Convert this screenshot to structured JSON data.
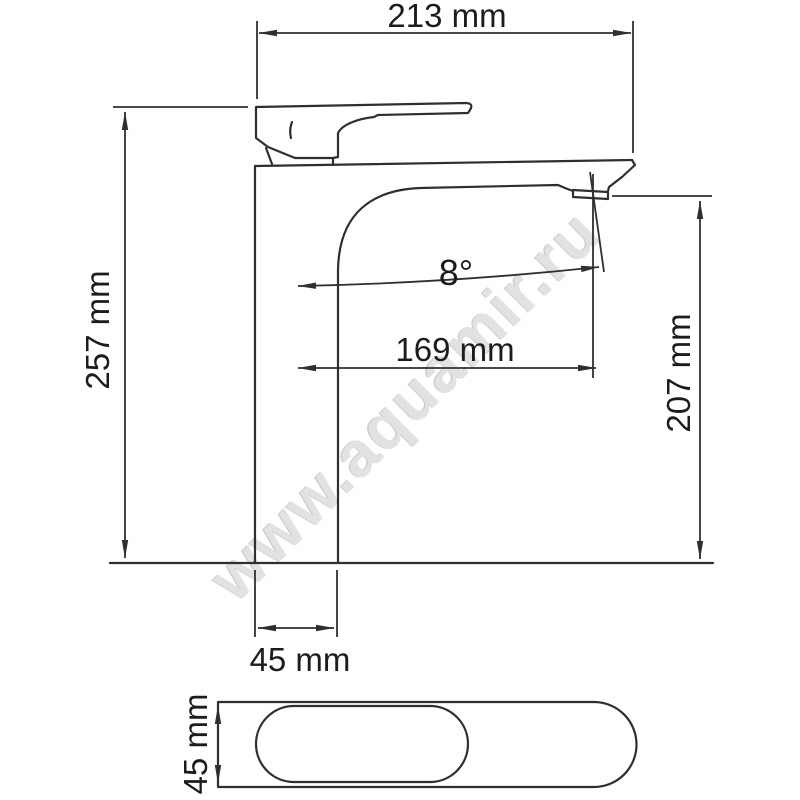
{
  "drawing": {
    "watermark": "www.aquamir.ru",
    "colors": {
      "line": "#2f2f2f",
      "label": "#1c1c1c",
      "watermark": "#e2e2e2",
      "background": "#ffffff"
    },
    "dimensions": {
      "top_width": "213 mm",
      "overall_height": "257 mm",
      "spout_angle": "8°",
      "spout_reach": "169 mm",
      "outlet_height": "207 mm",
      "body_width": "45 mm",
      "base_width": "45 mm"
    }
  }
}
